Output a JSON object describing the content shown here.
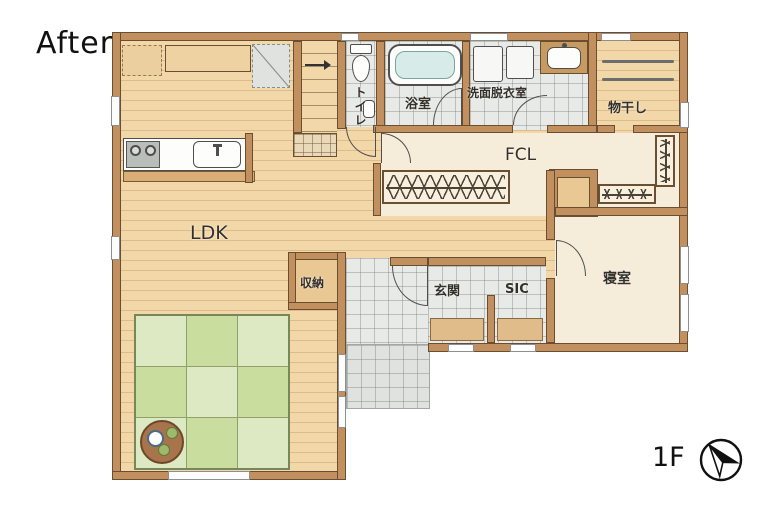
{
  "title": "After",
  "floor": {
    "label": "1F"
  },
  "compass": {
    "icon": "compass-north-icon",
    "points": "north-west"
  },
  "rooms": {
    "ldk": {
      "label": "LDK"
    },
    "toilet": {
      "label": "トイレ"
    },
    "bath": {
      "label": "浴室"
    },
    "washroom": {
      "label": "洗面脱衣室"
    },
    "drying": {
      "label": "物干し"
    },
    "fcl": {
      "label": "FCL"
    },
    "storage": {
      "label": "収納"
    },
    "entrance": {
      "label": "玄関"
    },
    "sic": {
      "label": "SIC"
    },
    "bedroom": {
      "label": "寝室"
    }
  },
  "fixtures": [
    "kitchen-stove-icon",
    "kitchen-sink-icon",
    "refrigerator-space-icon",
    "pantry-icon",
    "stairs-icon",
    "toilet-icon",
    "hand-basin-icon",
    "bathtub-icon",
    "washing-machine-icon",
    "vanity-sink-icon",
    "drying-pole-icon",
    "hanger-rack-icon",
    "tatami-mat-icon",
    "tea-table-icon",
    "entrance-step-icon",
    "door-swing-icon",
    "window-icon"
  ],
  "colors": {
    "wall": "#c2905f",
    "wall_outline": "#6a4e31",
    "wood_floor": "#f2d7a8",
    "tile_floor": "#e8eae7",
    "cream_floor": "#f6ecda",
    "tatami_light": "#dce9c3",
    "tatami_dark": "#c9dd9f",
    "bath_water": "#d7ebe9",
    "text": "#33302a"
  }
}
